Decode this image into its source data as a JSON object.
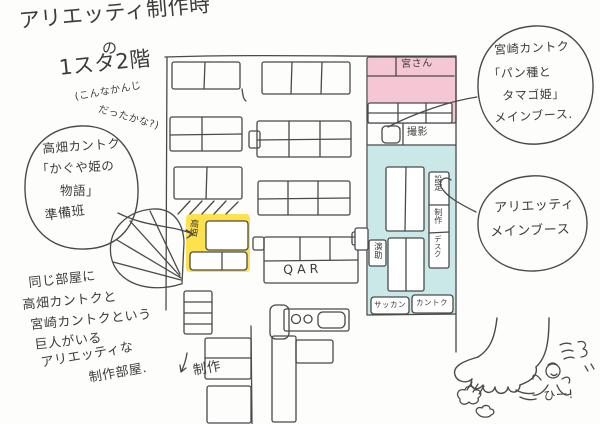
{
  "title": {
    "line1": "アリエッティ制作時",
    "particle": "の",
    "line2": "1スタ2階",
    "note_line1": "(こんなかんじ",
    "note_line2": "だったかな?)"
  },
  "bubble_takahata": {
    "line1": "高畑カントク",
    "line2": "「かぐや姫の",
    "line3": "物語」",
    "line4": "準備班"
  },
  "bubble_miyazaki": {
    "line1": "宮崎カントク",
    "line2": "「パン種と",
    "line3": "タマゴ姫」",
    "line4": "メインブース."
  },
  "bubble_arrietty": {
    "line1": "アリエッティ",
    "line2": "メインブース"
  },
  "note_bottom_left": {
    "line1": "同じ部屋に",
    "line2": "高畑カントクと",
    "line3": "宮崎カントクという",
    "line4": "巨人がいる",
    "line5": "アリエッティな",
    "line6": "制作部屋."
  },
  "plan": {
    "miyazaki_room_label": "宮さん",
    "photography_label": "撮影",
    "strip_cell1": "設定",
    "strip_cell2": "制作",
    "strip_cell3": "デスク",
    "assistant_director_label": "演助",
    "animation_director_label": "サッカン",
    "director_label": "カントク",
    "takahata_desk_label": "高畑",
    "qar_label": "QAR",
    "production_label": "制作"
  },
  "foot_scene": {
    "exclamation": "ひー!"
  },
  "colors": {
    "pink": "#f5c6d3",
    "cyan": "#c9e8e7",
    "yellow": "#ffe14d",
    "ink": "#4a4a4a"
  }
}
